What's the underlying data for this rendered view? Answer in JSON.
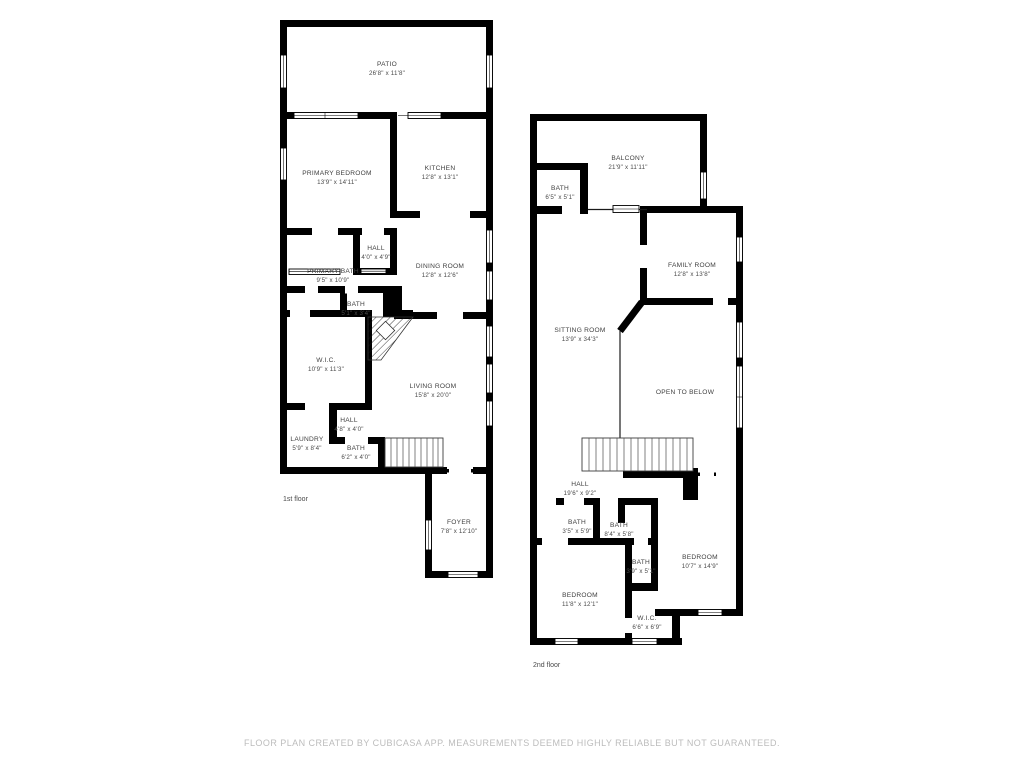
{
  "footer": {
    "disclaimer": "FLOOR PLAN CREATED BY CUBICASA APP. MEASUREMENTS DEEMED HIGHLY RELIABLE BUT NOT GUARANTEED."
  },
  "colors": {
    "wall": "#000000",
    "room_label": "#3f3f3f",
    "disclaimer": "#bcbcbc",
    "background": "#ffffff"
  },
  "floor1": {
    "label": "1st floor",
    "rooms": [
      {
        "name": "PATIO",
        "dims": "26'8\" x 11'8\""
      },
      {
        "name": "PRIMARY BEDROOM",
        "dims": "13'9\" x 14'11\""
      },
      {
        "name": "KITCHEN",
        "dims": "12'8\" x 13'1\""
      },
      {
        "name": "HALL",
        "dims": "4'0\" x 4'9\""
      },
      {
        "name": "PRIMARY BATH",
        "dims": "9'5\" x 10'9\""
      },
      {
        "name": "DINING ROOM",
        "dims": "12'8\" x 12'6\""
      },
      {
        "name": "BATH",
        "dims": "5'1\" x 3'4\""
      },
      {
        "name": "W.I.C.",
        "dims": "10'9\" x 11'3\""
      },
      {
        "name": "LIVING ROOM",
        "dims": "15'8\" x 20'0\""
      },
      {
        "name": "HALL",
        "dims": "4'8\" x 4'0\""
      },
      {
        "name": "LAUNDRY",
        "dims": "5'9\" x 8'4\""
      },
      {
        "name": "BATH",
        "dims": "6'2\" x 4'0\""
      },
      {
        "name": "FOYER",
        "dims": "7'8\" x 12'10\""
      }
    ]
  },
  "floor2": {
    "label": "2nd floor",
    "rooms": [
      {
        "name": "BALCONY",
        "dims": "21'9\" x 11'11\""
      },
      {
        "name": "BATH",
        "dims": "6'5\" x 5'1\""
      },
      {
        "name": "FAMILY ROOM",
        "dims": "12'8\" x 13'8\""
      },
      {
        "name": "SITTING ROOM",
        "dims": "13'9\" x 34'3\""
      },
      {
        "name": "OPEN TO BELOW",
        "dims": ""
      },
      {
        "name": "HALL",
        "dims": "19'6\" x 9'2\""
      },
      {
        "name": "BATH",
        "dims": "3'5\" x 5'9\""
      },
      {
        "name": "BATH",
        "dims": "8'4\" x 5'8\""
      },
      {
        "name": "BATH",
        "dims": "3'9\" x 5'1\""
      },
      {
        "name": "BEDROOM",
        "dims": "10'7\" x 14'9\""
      },
      {
        "name": "BEDROOM",
        "dims": "11'8\" x 12'1\""
      },
      {
        "name": "W.I.C.",
        "dims": "6'6\" x 6'9\""
      }
    ]
  }
}
